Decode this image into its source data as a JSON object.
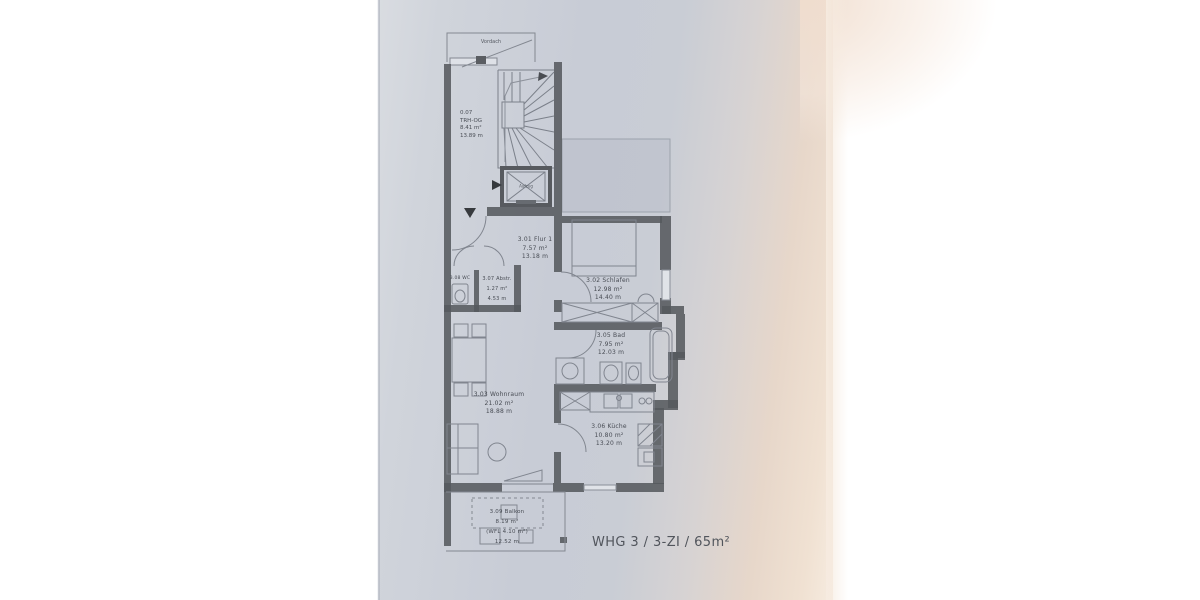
{
  "photo": {
    "paper_color": "#c9cdd5",
    "warm_tint_color": "#f0e1d2",
    "margin_color": "#ffffff",
    "wall_color": "#515459",
    "line_color": "#71767f",
    "text_color": "#484c54"
  },
  "plan": {
    "annotations": {
      "vordach": "Vordach",
      "aufzug": "Aufzug"
    },
    "stairwell": {
      "number": "0.07",
      "name": "TRH-OG",
      "area": "8.41 m²",
      "perimeter": "13.89 m"
    },
    "rooms": {
      "flur": {
        "label": "3.01 Flur 1",
        "area": "7.57 m²",
        "perimeter": "13.18 m"
      },
      "schlafen": {
        "label": "3.02 Schlafen",
        "area": "12.98 m²",
        "perimeter": "14.40 m"
      },
      "wohnraum": {
        "label": "3.03 Wohnraum",
        "area": "21.02 m²",
        "perimeter": "18.88 m"
      },
      "bad": {
        "label": "3.05 Bad",
        "area": "7.95 m²",
        "perimeter": "12.03 m"
      },
      "kueche": {
        "label": "3.06 Küche",
        "area": "10.80 m²",
        "perimeter": "13.20 m"
      },
      "abstellraum": {
        "label": "3.07 Abstr.",
        "area": "1.27 m²",
        "perimeter": "4.53 m"
      },
      "wc": {
        "label": "3.08 WC"
      },
      "balkon": {
        "label": "3.09 Balkon",
        "area": "8.19 m²",
        "wfl": "(WFL 4.10 m²)",
        "perimeter": "12.52 m"
      }
    },
    "title": "WHG 3 / 3-ZI / 65m²"
  }
}
